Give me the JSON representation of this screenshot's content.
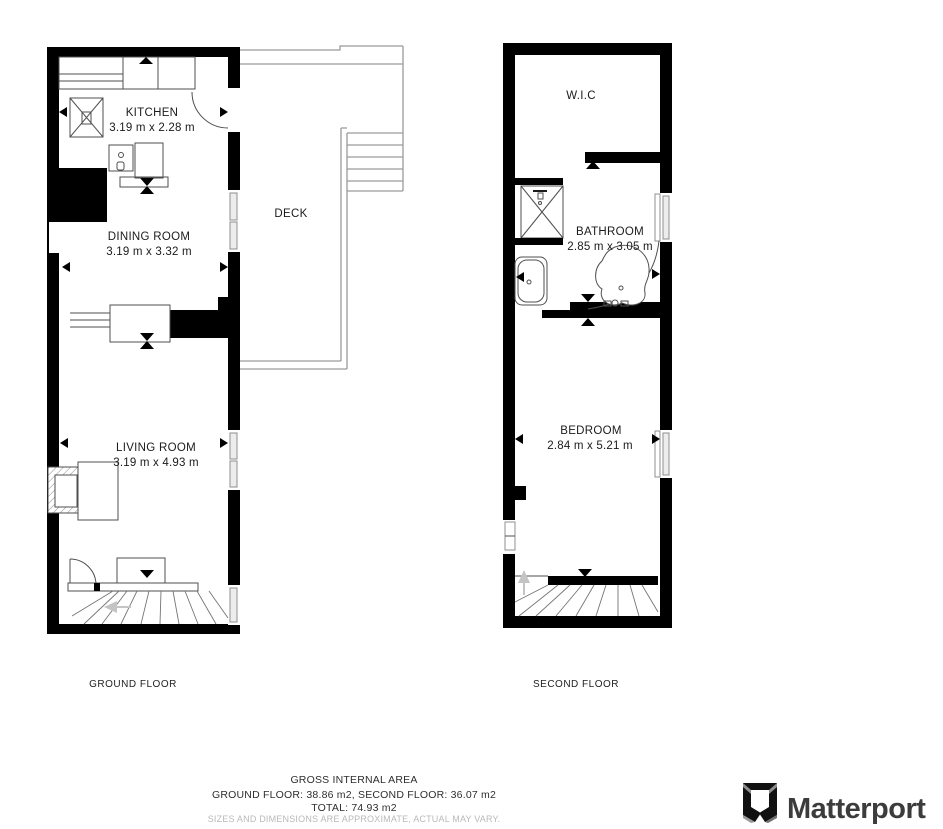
{
  "floors": {
    "ground": {
      "label": "GROUND FLOOR",
      "rooms": {
        "kitchen": {
          "name": "KITCHEN",
          "dims": "3.19 m x 2.28 m"
        },
        "dining": {
          "name": "DINING ROOM",
          "dims": "3.19 m x 3.32 m"
        },
        "living": {
          "name": "LIVING ROOM",
          "dims": "3.19 m x 4.93 m"
        },
        "deck": {
          "name": "DECK"
        }
      }
    },
    "second": {
      "label": "SECOND FLOOR",
      "rooms": {
        "wic": {
          "name": "W.I.C"
        },
        "bathroom": {
          "name": "BATHROOM",
          "dims": "2.85 m x 3.05 m"
        },
        "bedroom": {
          "name": "BEDROOM",
          "dims": "2.84 m x 5.21 m"
        }
      }
    }
  },
  "footer": {
    "title": "GROSS INTERNAL AREA",
    "areas": "GROUND FLOOR: 38.86 m2, SECOND FLOOR: 36.07 m2",
    "total": "TOTAL: 74.93 m2",
    "disclaimer": "SIZES AND DIMENSIONS ARE APPROXIMATE, ACTUAL MAY VARY."
  },
  "branding": {
    "logo_text": "Matterport"
  },
  "icons": {
    "dimension_arrow": "solid black triangle",
    "door_threshold_marker": "double-triangle bowtie",
    "window_vent_marker": "solid black triangle",
    "stair_direction_arrow": "light gray arrow",
    "matterport_mark": "folded-M logo glyph"
  },
  "colors": {
    "wall": "#000000",
    "furniture_line": "#4f4f4f",
    "deck_line": "#9a9a9a",
    "stair_line": "#757575",
    "window_fill": "#ededed",
    "text": "#1b1b1b",
    "muted_text": "#b9b9b9",
    "logo": "#3c3c3c",
    "ghost_arrow": "#c4c4c4"
  }
}
